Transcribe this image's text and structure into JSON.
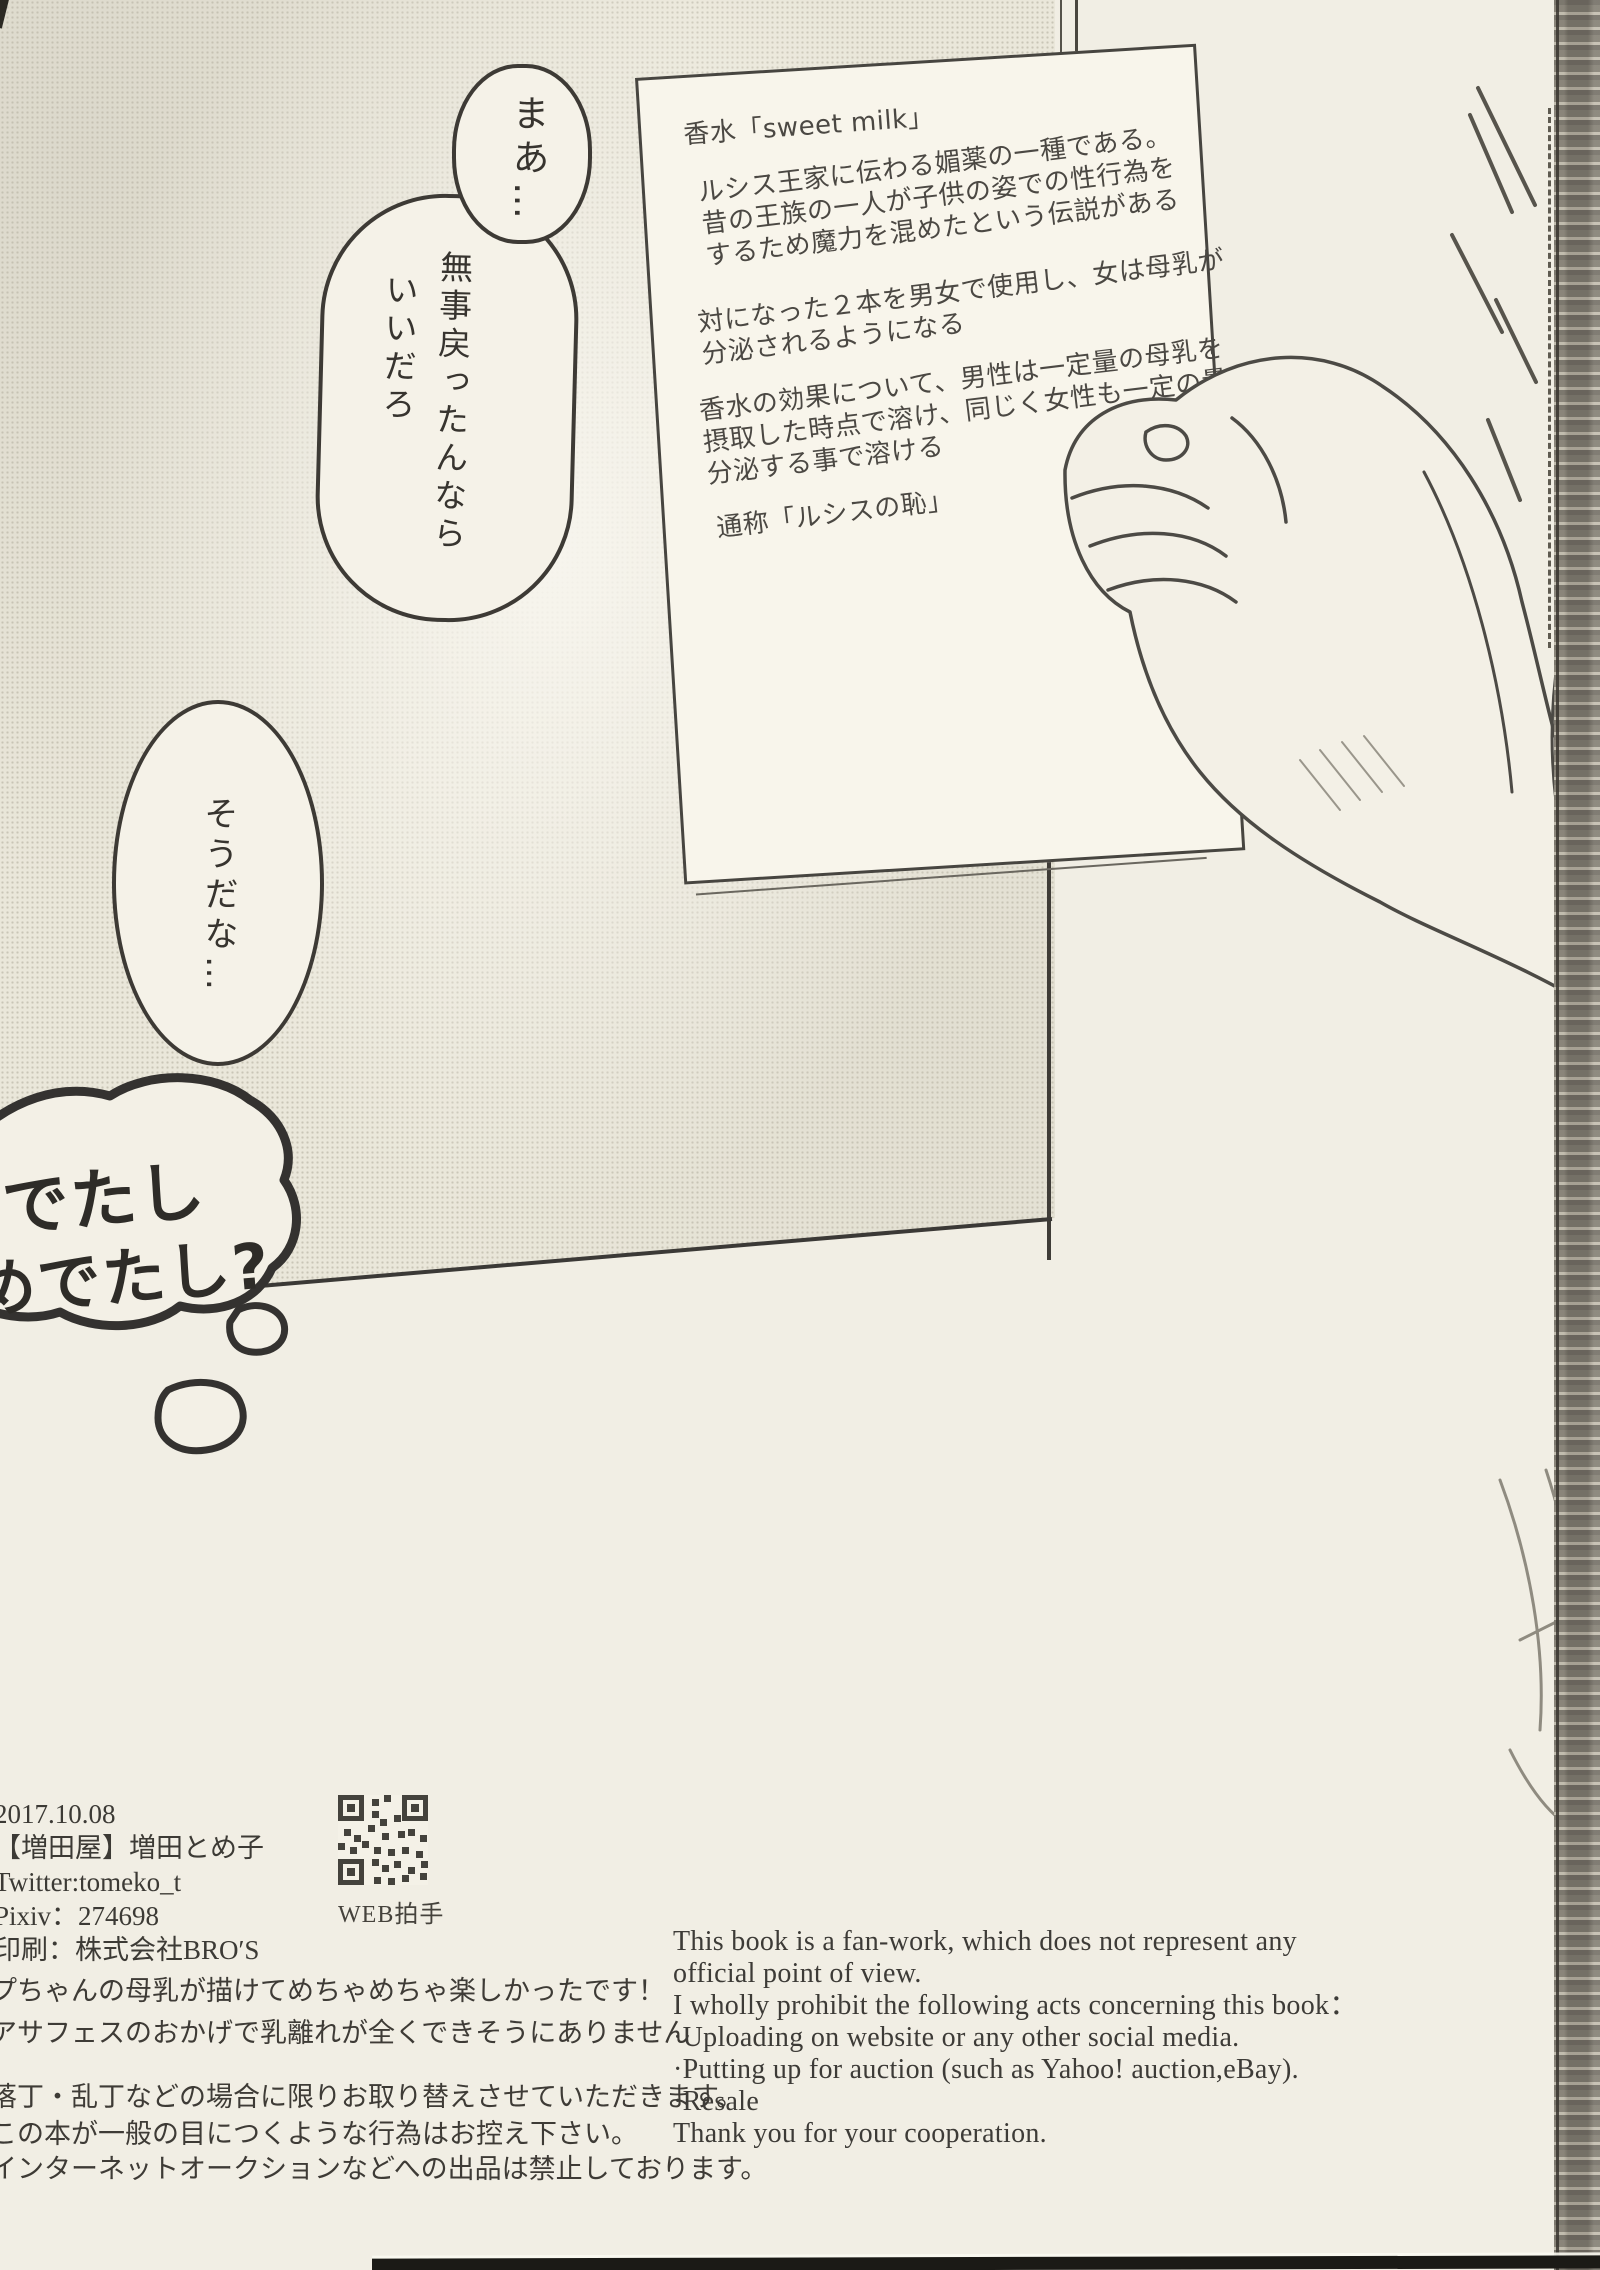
{
  "paper_note": {
    "title": "香水「sweet milk」",
    "lore": [
      "ルシス王家に伝わる媚薬の一種である。",
      "昔の王族の一人が子供の姿での性行為を",
      "するため魔力を混めたという伝説がある"
    ],
    "usage": [
      "対になった２本を男女で使用し、女は母乳が",
      "分泌されるようになる"
    ],
    "effect": [
      "香水の効果について、男性は一定量の母乳を",
      "摂取した時点で溶け、同じく女性も一定の量を",
      "分泌する事で溶ける"
    ],
    "alias": "通称「ルシスの恥」"
  },
  "bubbles": {
    "maa": "まあ…",
    "main_right": "無事戻ったんなら",
    "main_left": "いいだろ",
    "souda": "そうだな…",
    "thought": [
      "でたし",
      "めでたし?"
    ]
  },
  "colophon": {
    "date": "2017.10.08",
    "author": "【増田屋】増田とめ子",
    "twitter": "Twitter:tomeko_t",
    "pixiv": "Pixiv：274698",
    "printing": "印刷：株式会社BRO′S",
    "web_clap_label": "WEB拍手"
  },
  "afterword": [
    "プちゃんの母乳が描けてめちゃめちゃ楽しかったです！",
    "アサフェスのおかげで乳離れが全くできそうにありません",
    "落丁・乱丁などの場合に限りお取り替えさせていただきます。",
    "この本が一般の目につくような行為はお控え下さい。",
    "インターネットオークションなどへの出品は禁止しております。"
  ],
  "notice_en": [
    "This book is a fan-work, which does not represent any",
    "official point of view.",
    "I wholly prohibit the following acts concerning this book：",
    "·Uploading on website or any other social media.",
    "·Putting up for auction (such as Yahoo! auction,eBay).",
    "·Resale",
    "Thank you for your cooperation."
  ],
  "colors": {
    "page_background": "#f1eee4",
    "panel_halftone": "#eae7da",
    "note_paper": "#f8f5eb",
    "ink": "#3d3a35",
    "scan_edge_dark": "#1b1a16"
  }
}
